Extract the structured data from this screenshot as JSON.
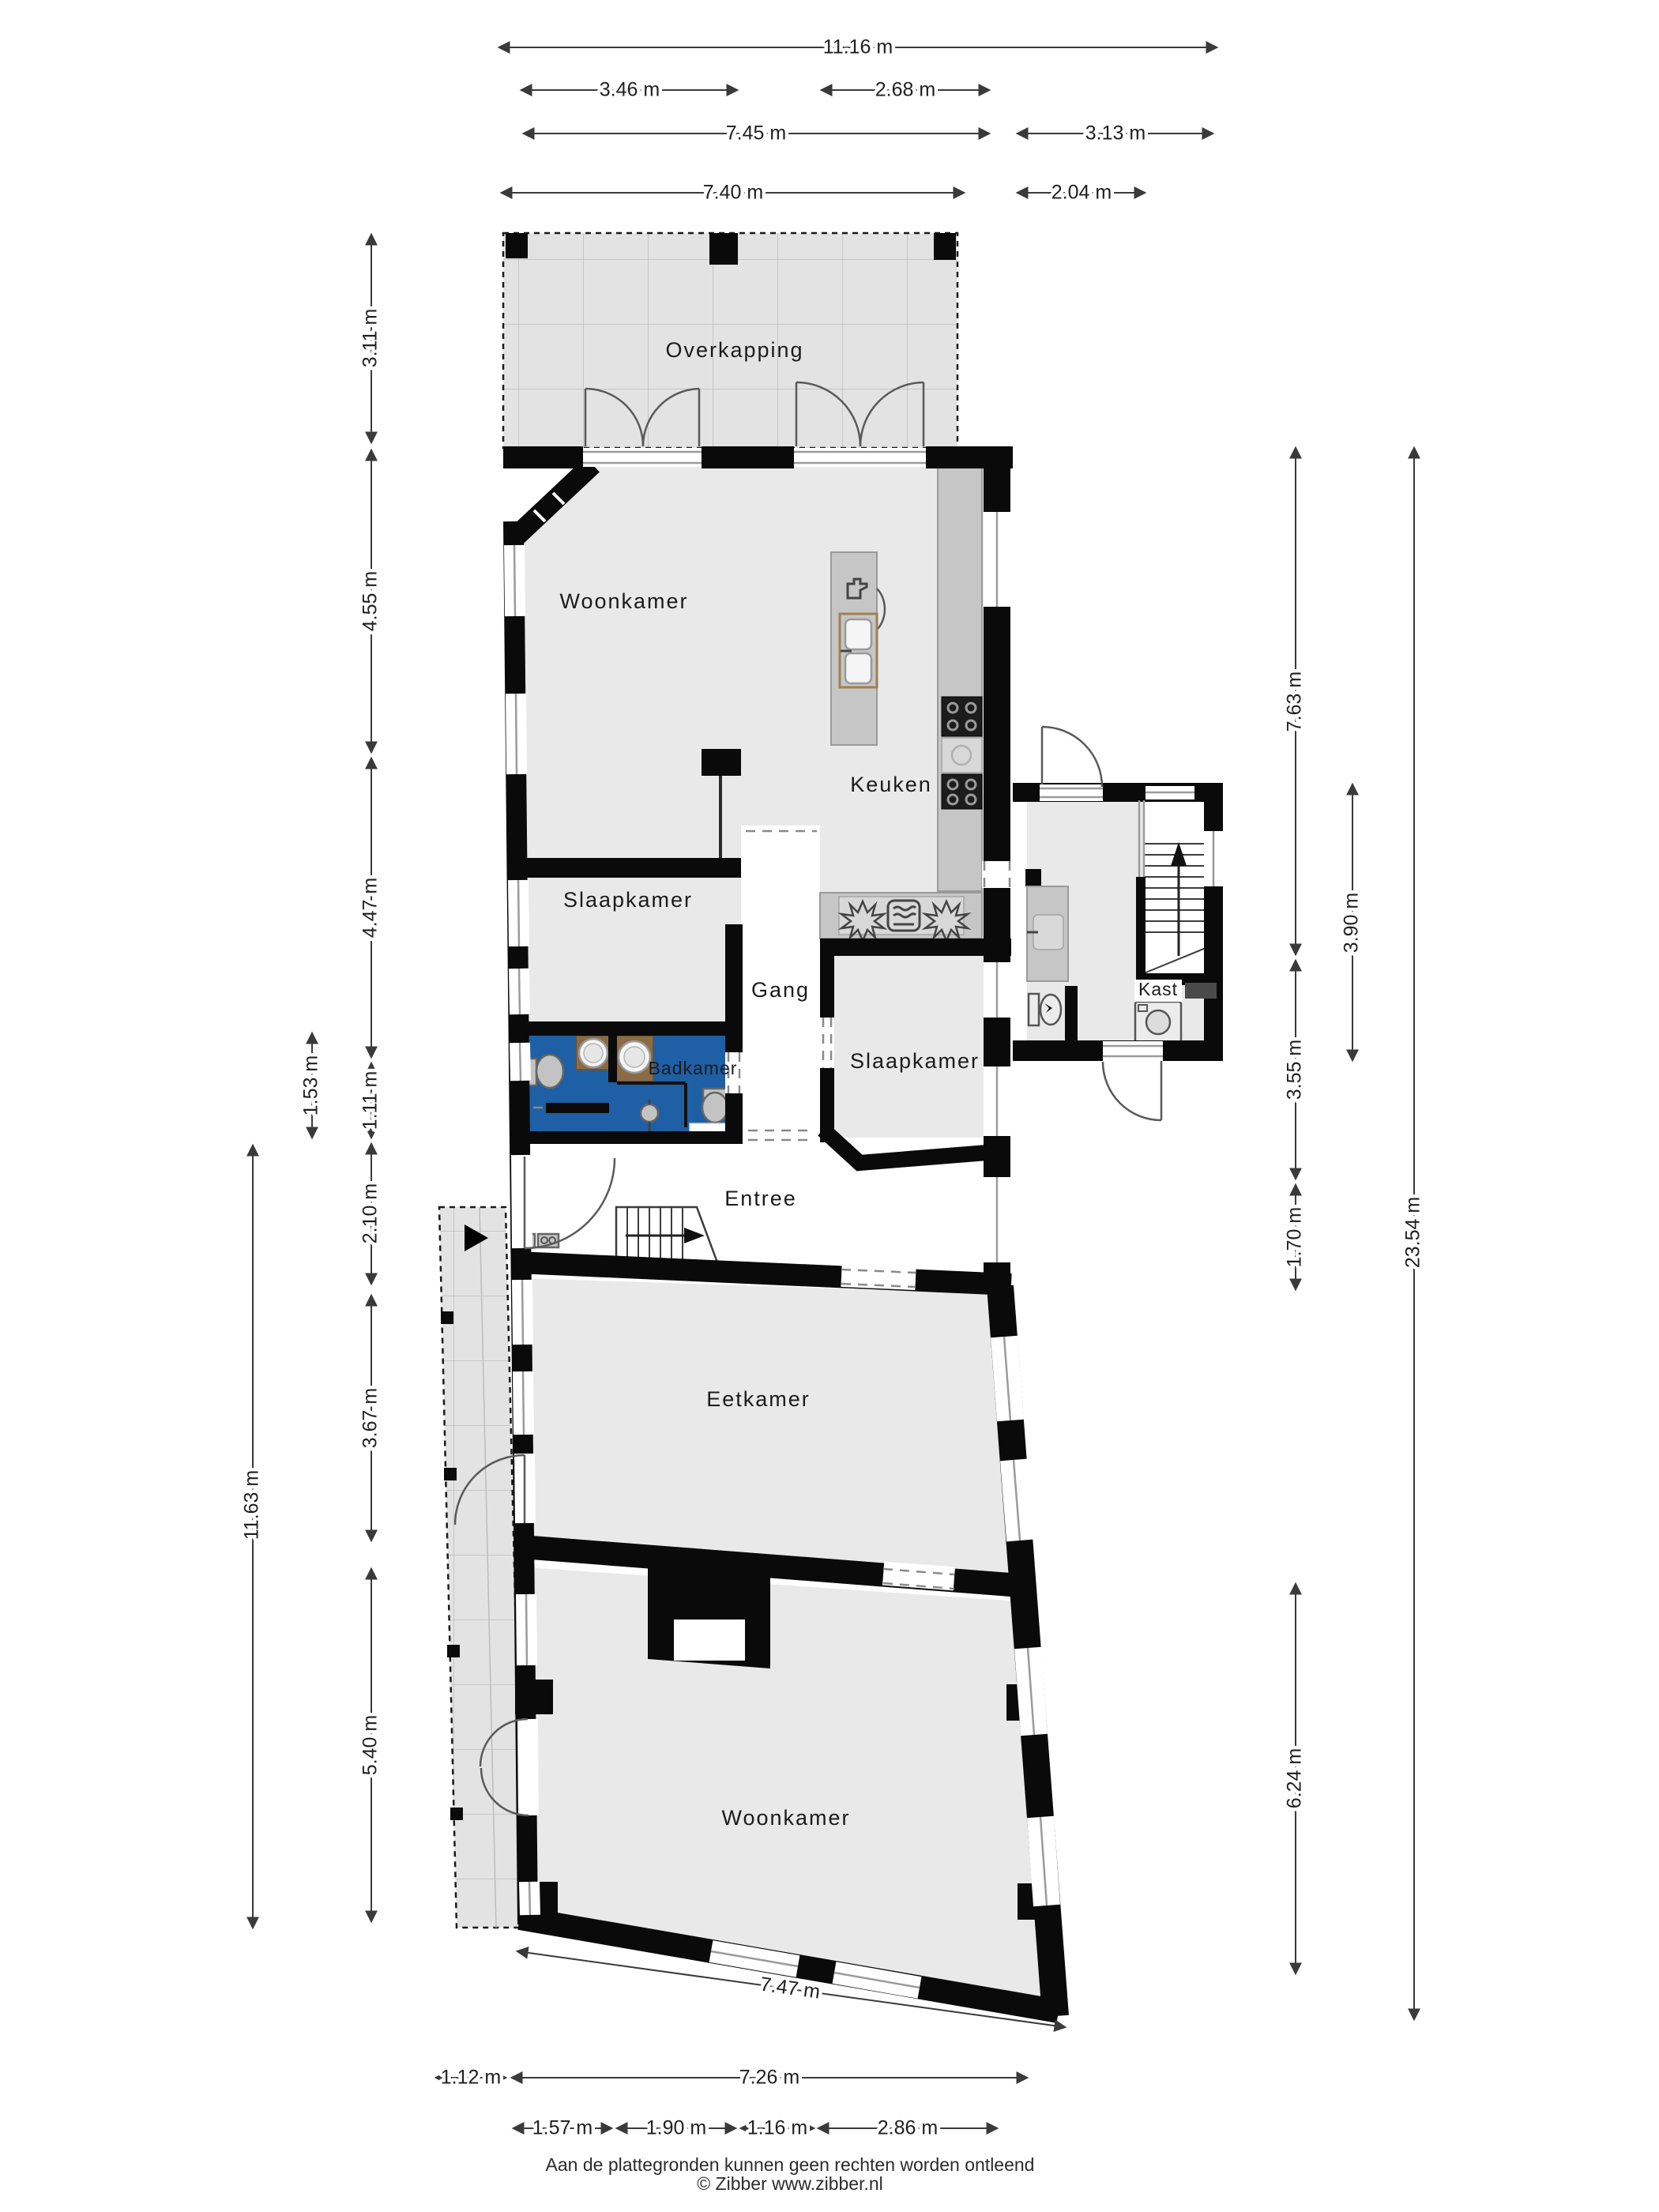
{
  "plan": {
    "rooms": {
      "overkapping": "Overkapping",
      "woonkamer_boven": "Woonkamer",
      "keuken": "Keuken",
      "slaapkamer_links": "Slaapkamer",
      "gang": "Gang",
      "badkamer": "Badkamer",
      "slaapkamer_rechts": "Slaapkamer",
      "kast": "Kast",
      "entree": "Entree",
      "eetkamer": "Eetkamer",
      "woonkamer_beneden": "Woonkamer"
    },
    "dimensions": {
      "top": [
        "11.16 m",
        "3.46 m",
        "2.68 m",
        "7.45 m",
        "3.13 m",
        "7.40 m",
        "2.04 m"
      ],
      "left": [
        "3.11 m",
        "4.55 m",
        "4.47 m",
        "1.53 m",
        "1.11 m",
        "2.10 m",
        "11.63 m",
        "3.67 m",
        "5.40 m"
      ],
      "right": [
        "7.63 m",
        "3.90 m",
        "3.55 m",
        "1.70 m",
        "23.54 m",
        "6.24 m"
      ],
      "bottom": [
        "7.47 m",
        "1.12 m",
        "7.26 m",
        "1.57 m",
        "1.90 m",
        "1.16 m",
        "2.86 m"
      ]
    },
    "icons": [
      "stairs-up-arrow-icon",
      "entrance-arrow-icon",
      "dishwasher-icon",
      "kitchen-sink-icon",
      "cooktop-icon",
      "gas-burner-icon",
      "oven-icon",
      "washbasin-icon",
      "toilet-icon",
      "shower-icon",
      "washing-machine-icon",
      "utility-sink-icon",
      "meter-cupboard-icon"
    ]
  },
  "footer": {
    "disclaimer": "Aan de plattegronden kunnen geen rechten worden ontleend",
    "copyright": "© Zibber www.zibber.nl"
  },
  "colors": {
    "wall": "#0a0a0a",
    "floor": "#e9e9e9",
    "outside_floor": "#e3e3e3",
    "bath": "#1e5fa5",
    "counter": "#c6c6c6",
    "wood": "#8a6b45",
    "dim": "#3a3a3a"
  }
}
